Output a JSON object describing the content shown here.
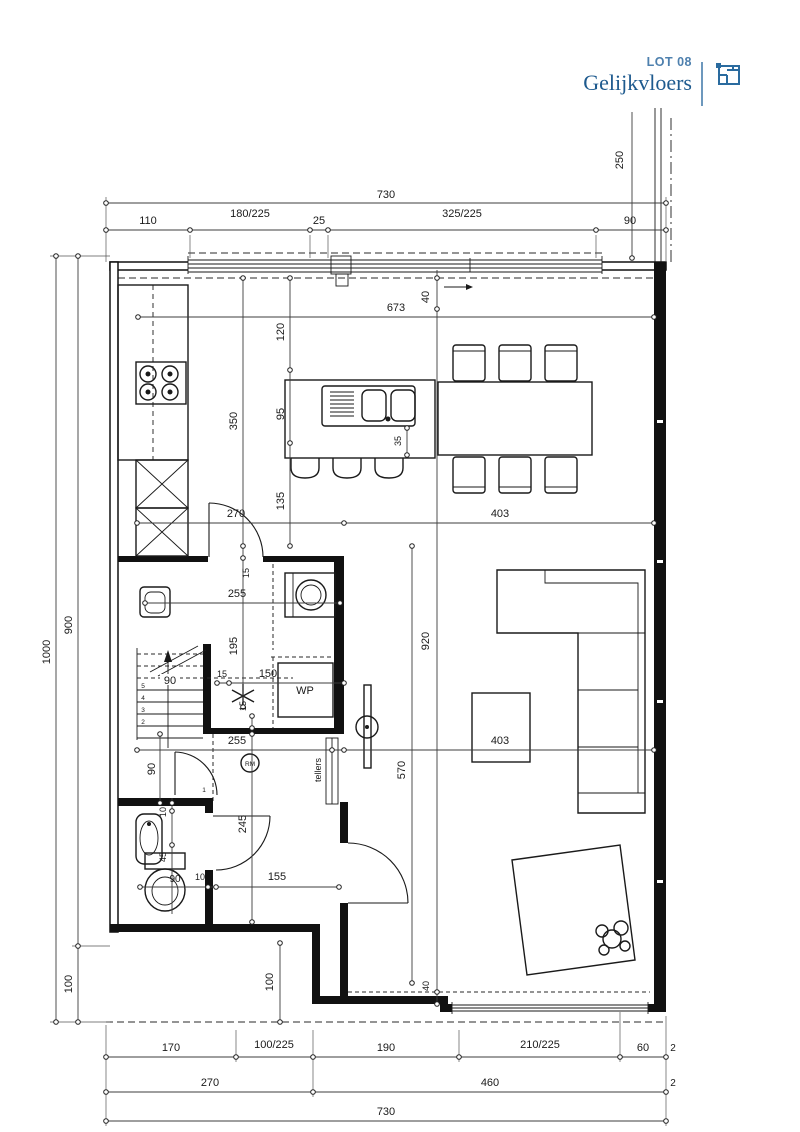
{
  "header": {
    "lot": "LOT 08",
    "floor": "Gelijkvloers",
    "accent_color": "#1e5a8e"
  },
  "plan": {
    "labels": {
      "wp": "WP",
      "rm": "RM",
      "tellers": "tellers"
    },
    "stairs": {
      "n1": "1",
      "n2": "2",
      "n3": "3",
      "n4": "4",
      "n5": "5"
    },
    "dims": {
      "top_total": "730",
      "top_a": "110",
      "top_b": "180/225",
      "top_c": "25",
      "top_d": "325/225",
      "top_e": "90",
      "right_a": "250",
      "left_total": "1000",
      "left_a": "900",
      "left_b": "100",
      "b1_a": "170",
      "b1_b": "100/225",
      "b1_c": "190",
      "b1_d": "210/225",
      "b1_e": "60",
      "b1_f": "2",
      "b2_a": "270",
      "b2_b": "460",
      "b2_c": "2",
      "b3_total": "730",
      "k673": "673",
      "k120": "120",
      "k95": "95",
      "k135": "135",
      "k350": "350",
      "k40t": "40",
      "k35": "35",
      "m270": "270",
      "m403a": "403",
      "m920": "920",
      "m570": "570",
      "m403b": "403",
      "u15a": "15",
      "u195": "195",
      "u255a": "255",
      "u15b": "15",
      "u150": "150",
      "u15c": "15",
      "u255b": "255",
      "s90": "90",
      "h90": "90",
      "h245": "245",
      "w10a": "10",
      "w45": "45",
      "w90": "90",
      "w10b": "10",
      "w155": "155",
      "e100": "100",
      "e40b": "40"
    }
  }
}
